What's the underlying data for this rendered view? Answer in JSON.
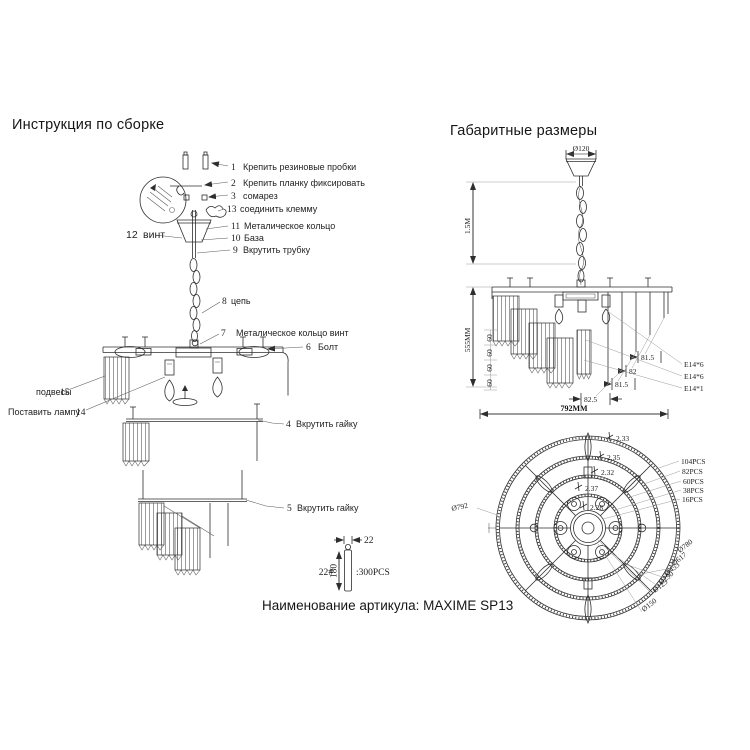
{
  "titles": {
    "left": "Инструкция по сборке",
    "right": "Габаритные размеры",
    "footer": "Наименование артикула: MAXIME SP13"
  },
  "assembly": {
    "callouts": [
      {
        "num": "1",
        "label": "Крепить резиновые пробки"
      },
      {
        "num": "2",
        "label": "Крепить планку фиксировать"
      },
      {
        "num": "3",
        "label": "сомарез"
      },
      {
        "num": "13",
        "label": "соединить клемму"
      },
      {
        "num": "11",
        "label": "Металическое кольцо"
      },
      {
        "num": "10",
        "label": "База"
      },
      {
        "num": "9",
        "label": "Вкрутить трубку"
      },
      {
        "num": "12",
        "label": "винт"
      },
      {
        "num": "8",
        "label": "цепь"
      },
      {
        "num": "7",
        "label": "Металическое кольцо винт"
      },
      {
        "num": "6",
        "label": "Болт"
      },
      {
        "num": "15",
        "label": "подвесы"
      },
      {
        "num": "14",
        "label": "Поставить лампу"
      },
      {
        "num": "4",
        "label": "Вкрутить гайку"
      },
      {
        "num": "5",
        "label": "Вкрутить гайку"
      }
    ],
    "pendant_detail": {
      "width": "22",
      "code": "22#",
      "length": "180",
      "qty": ":300PCS"
    }
  },
  "side_view": {
    "canopy_dia": "Ø120",
    "chain_len": "1.5M",
    "height": "555MM",
    "spacings": [
      "60",
      "60",
      "60",
      "60"
    ],
    "drops": [
      "81.5",
      "82",
      "81.5",
      "82.5"
    ],
    "sockets": [
      "E14*6",
      "E14*6",
      "E14*1"
    ],
    "width": "792MM"
  },
  "bottom_view": {
    "outer": "Ø792",
    "counts": [
      "104PCS",
      "82PCS",
      "60PCS",
      "38PCS",
      "16PCS"
    ],
    "diameters": [
      "Ø780",
      "Ø617",
      "Ø453",
      "Ø290",
      "Ø125",
      "Ø150"
    ],
    "gaps": [
      "2.33",
      "2.35",
      "2.32",
      "2.37",
      "2.28"
    ]
  },
  "colors": {
    "ink": "#2e2e2e",
    "leader": "#9a9a9a",
    "background": "#ffffff"
  }
}
